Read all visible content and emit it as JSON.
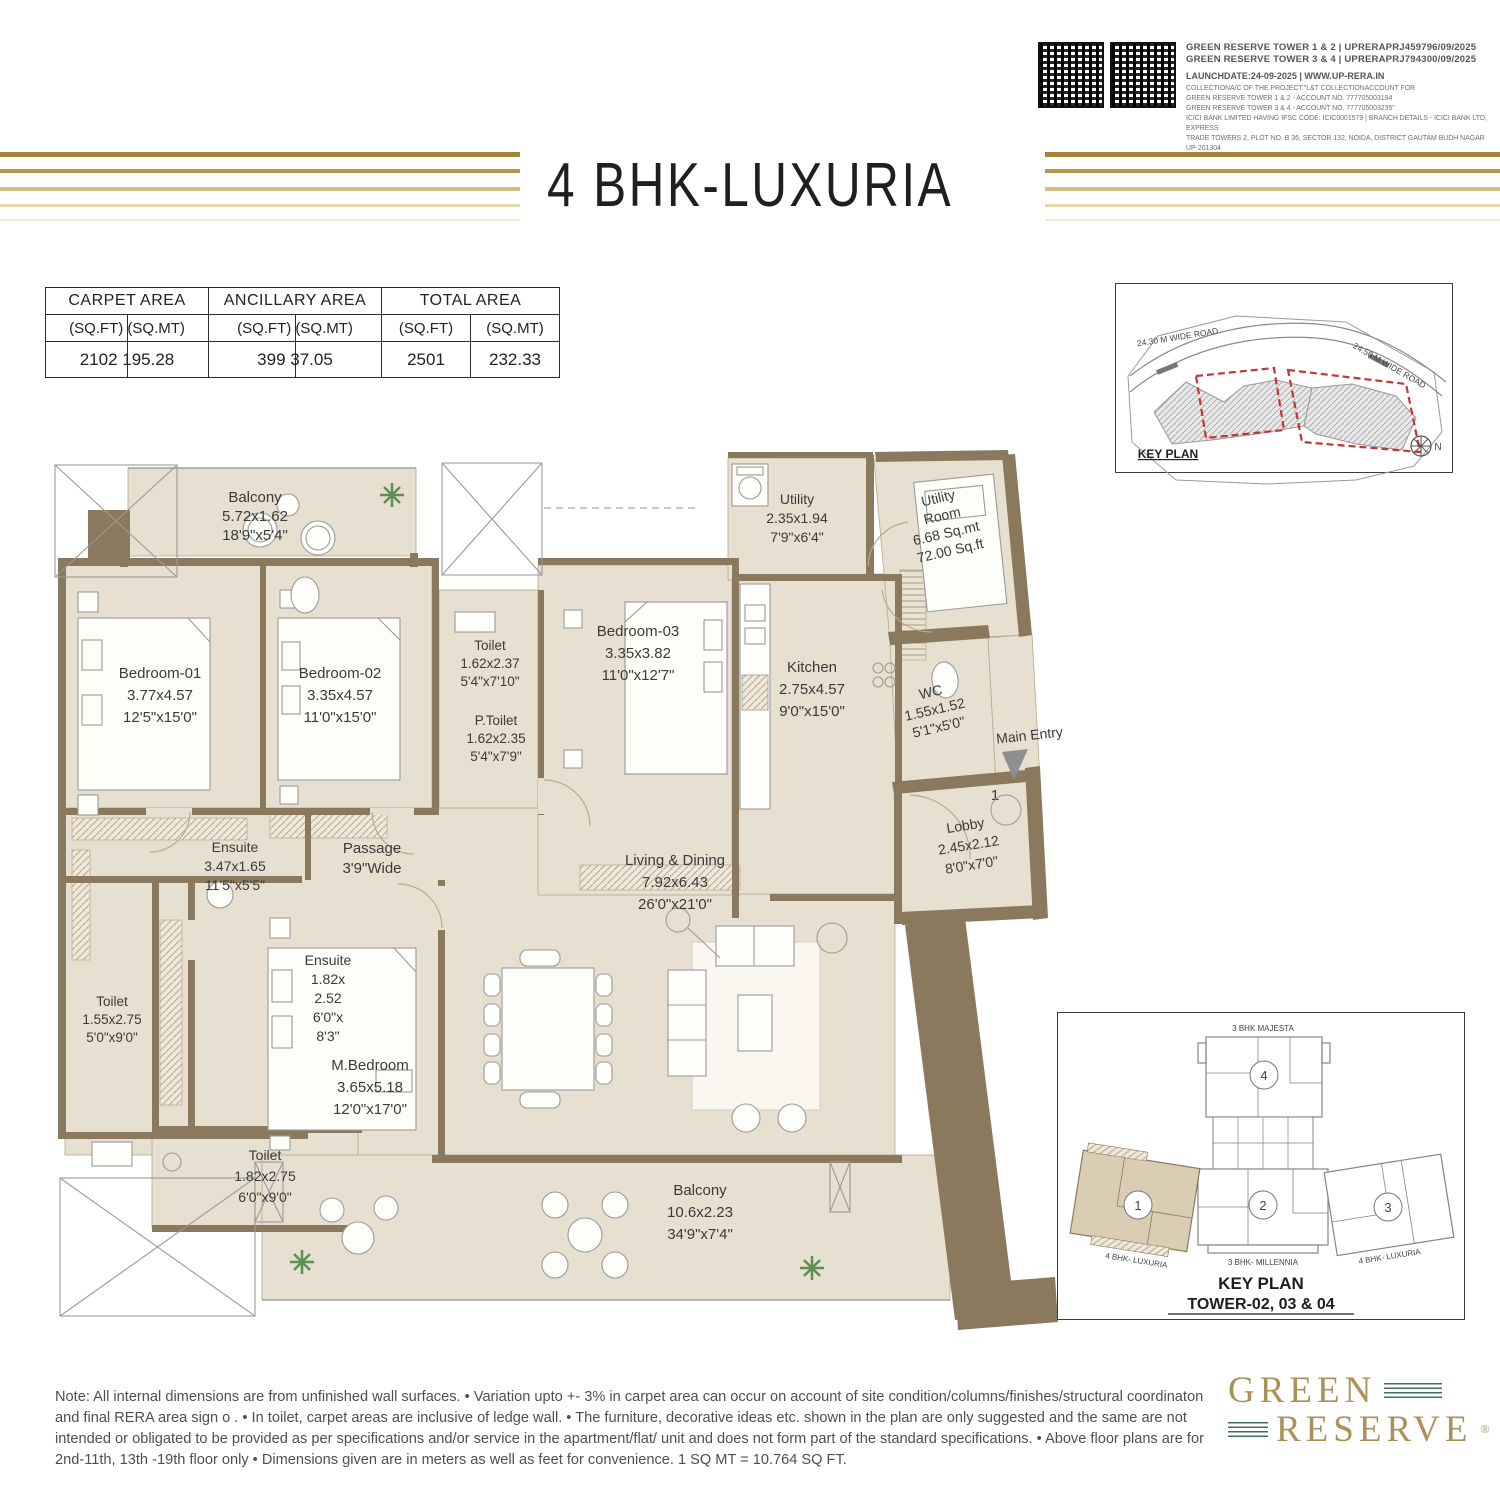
{
  "rera": {
    "tower12": "GREEN RESERVE TOWER 1 & 2 | UPRERAPRJ459796/09/2025",
    "tower34": "GREEN RESERVE TOWER 3 & 4 | UPRERAPRJ794300/09/2025",
    "launch": "LAUNCHDATE:24-09-2025 | WWW.UP-RERA.IN",
    "fine1": "COLLECTIONA/C OF THE PROJECT:\"L&T COLLECTIONACCOUNT FOR",
    "fine2": "GREEN RESERVE TOWER 1 & 2 - ACCOUNT NO. 777705003194",
    "fine3": "GREEN RESERVE TOWER 3 & 4 - ACCOUNT NO. 777705003235\"",
    "fine4": "ICICI BANK LIMITED HAVING IFSC CODE: ICIC0001579 | BRANCH DETAILS - ICICI BANK LTD, EXPRESS",
    "fine5": "TRADE TOWERS 2, PLOT NO. B 36, SECTOR 132, NOIDA, DISTRICT GAUTAM BUDH NAGAR UP-201304"
  },
  "title": "4 BHK-LUXURIA",
  "area_table": {
    "h1": "CARPET AREA",
    "h2": "ANCILLARY AREA",
    "h3": "TOTAL AREA",
    "sqft": "(SQ.FT)",
    "sqmt": "(SQ.MT)",
    "carpet_sub": "(SQ.FT) (SQ.MT)",
    "ancillary_sub": "(SQ.FT) (SQ.MT)",
    "carpet_val": "2102 195.28",
    "ancillary_val": "399 37.05",
    "total_sqft": "2501",
    "total_sqmt": "232.33"
  },
  "keyplan_top": {
    "label": "KEY PLAN",
    "road_left": "24.30 M WIDE ROAD",
    "road_right": "24.50 M WIDE ROAD",
    "north": "N"
  },
  "rooms": {
    "balcony_top": {
      "name": "Balcony",
      "m": "5.72x1.62",
      "ft": "18'9\"x5'4\""
    },
    "bedroom1": {
      "name": "Bedroom-01",
      "m": "3.77x4.57",
      "ft": "12'5\"x15'0\""
    },
    "bedroom2": {
      "name": "Bedroom-02",
      "m": "3.35x4.57",
      "ft": "11'0\"x15'0\""
    },
    "toilet_common": {
      "name": "Toilet",
      "m": "1.62x2.37",
      "ft": "5'4\"x7'10\""
    },
    "p_toilet": {
      "name": "P.Toilet",
      "m": "1.62x2.35",
      "ft": "5'4\"x7'9\""
    },
    "bedroom3": {
      "name": "Bedroom-03",
      "m": "3.35x3.82",
      "ft": "11'0\"x12'7\""
    },
    "utility": {
      "name": "Utility",
      "m": "2.35x1.94",
      "ft": "7'9\"x6'4\""
    },
    "utility_room": {
      "name1": "Utility",
      "name2": "Room",
      "m": "6.68 Sq.mt",
      "ft": "72.00 Sq.ft"
    },
    "kitchen": {
      "name": "Kitchen",
      "m": "2.75x4.57",
      "ft": "9'0\"x15'0\""
    },
    "wc": {
      "name": "WC",
      "m": "1.55x1.52",
      "ft": "5'1\"x5'0\""
    },
    "main_entry": {
      "name": "Main Entry"
    },
    "lobby": {
      "name": "Lobby",
      "m": "2.45x2.12",
      "ft": "8'0\"x7'0\""
    },
    "lobby_marker": "1",
    "ensuite1": {
      "name": "Ensuite",
      "m": "3.47x1.65",
      "ft": "11'5\"x5'5\""
    },
    "passage": {
      "name": "Passage",
      "ft": "3'9\"Wide"
    },
    "ensuite2": {
      "name": "Ensuite",
      "m1": "1.82x",
      "m2": "2.52",
      "ft1": "6'0\"x",
      "ft2": "8'3\""
    },
    "toilet_left": {
      "name": "Toilet",
      "m": "1.55x2.75",
      "ft": "5'0\"x9'0\""
    },
    "m_bedroom": {
      "name": "M.Bedroom",
      "m": "3.65x5.18",
      "ft": "12'0\"x17'0\""
    },
    "living": {
      "name": "Living & Dining",
      "m": "7.92x6.43",
      "ft": "26'0\"x21'0\""
    },
    "toilet_bottom": {
      "name": "Toilet",
      "m": "1.82x2.75",
      "ft": "6'0\"x9'0\""
    },
    "balcony_bottom": {
      "name": "Balcony",
      "m": "10.6x2.23",
      "ft": "34'9\"x7'4\""
    }
  },
  "keyplan_bottom": {
    "top_label": "3 BHK MAJESTA",
    "unit1": "1",
    "unit2": "2",
    "unit3": "3",
    "unit4": "4",
    "left_label": "4 BHK- LUXURIA",
    "right_label": "4 BHK- LUXURIA",
    "bottom_label": "3 BHK- MILLENNIA",
    "title1": "KEY PLAN",
    "title2": "TOWER-02, 03 & 04"
  },
  "note": "Note: All internal dimensions are from unfinished wall surfaces. • Variation upto +- 3% in carpet area can occur on account of site condition/columns/finishes/structural coordinaton and final RERA area sign o . • In toilet, carpet areas are inclusive of ledge wall. • The furniture, decorative ideas etc. shown in the plan are only suggested and the same are not intended or obligated to be provided as per specifications and/or service in the apartment/flat/ unit and does not form part of the standard specifications. • Above floor plans are for 2nd-11th, 13th -19th floor only • Dimensions given are in meters as well as feet for convenience. 1 SQ MT = 10.764 SQ FT.",
  "logo": {
    "line1": "GREEN",
    "line2": "RESERVE",
    "reg": "®"
  },
  "colors": {
    "wall_brown": "#8a795c",
    "floor_beige": "#e7dfd0",
    "gold": "#a5823a",
    "logo_gold": "#ab9157",
    "logo_green": "#42705f",
    "keyplan_red": "#c63434"
  }
}
